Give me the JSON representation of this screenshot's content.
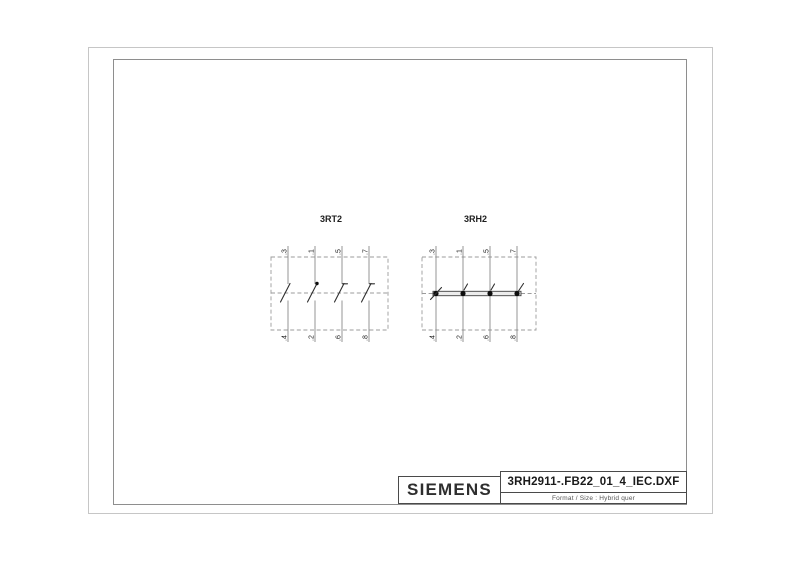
{
  "diagrams": [
    {
      "label": "3RT2",
      "terminals_top": [
        ".3",
        ".1",
        ".5",
        ".7"
      ],
      "terminals_bottom": [
        ".4",
        ".2",
        ".6",
        ".8"
      ]
    },
    {
      "label": "3RH2",
      "terminals_top": [
        ".3",
        ".1",
        ".5",
        ".7"
      ],
      "terminals_bottom": [
        ".4",
        ".2",
        ".6",
        ".8"
      ]
    }
  ],
  "title_block": {
    "brand": "SIEMENS",
    "filename": "3RH2911-.FB22_01_4_IEC.DXF",
    "format_label": "Format / Size : Hybrid quer"
  },
  "colors": {
    "outer_frame": "#c6c6c6",
    "inner_frame": "#8e8e8e",
    "wire": "#8a8a8a",
    "dashed_outline": "#9b9b9b",
    "contact": "#2f2f2f",
    "text": "#1d1d1d"
  }
}
